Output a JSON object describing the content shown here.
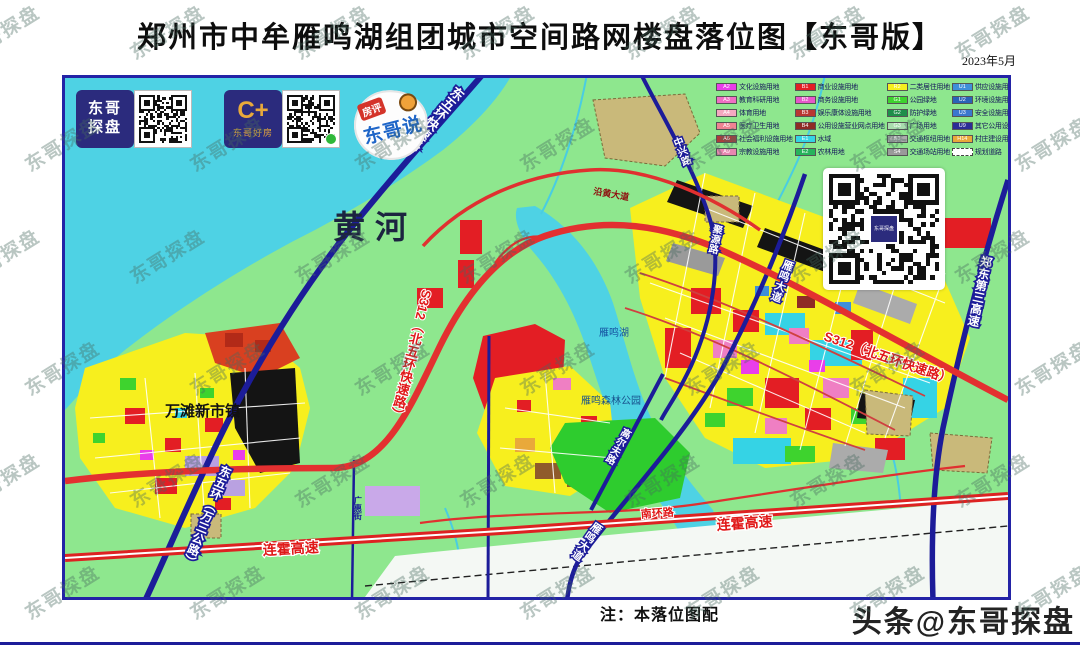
{
  "title": "郑州市中牟雁鸣湖组团城市空间路网楼盘落位图【东哥版】",
  "date": "2023年5月",
  "note": "注：本落位图配",
  "watermark": {
    "tile": "东哥探盘",
    "corner": "头条@东哥探盘"
  },
  "logos": {
    "logo1": {
      "name": "东哥探盘",
      "line1": "东哥",
      "line2": "探盘"
    },
    "logo2": {
      "mark": "C+",
      "name": "东哥好房"
    },
    "logo3": {
      "tag": "房评",
      "name": "东哥说"
    }
  },
  "legend": {
    "columns": [
      {
        "items": [
          {
            "code": "A2",
            "color": "#e93ee9",
            "label": "文化设施用地"
          },
          {
            "code": "A3",
            "color": "#ef6fc3",
            "label": "教育科研用地"
          },
          {
            "code": "A4",
            "color": "#f4a8c0",
            "label": "体育用地"
          },
          {
            "code": "A5",
            "color": "#ef8292",
            "label": "医疗卫生用地"
          },
          {
            "code": "A6",
            "color": "#ae3b3b",
            "label": "社会福利设施用地"
          },
          {
            "code": "A9",
            "color": "#e887b0",
            "label": "宗教设施用地"
          }
        ]
      },
      {
        "items": [
          {
            "code": "B1",
            "color": "#e31e24",
            "label": "商业设施用地"
          },
          {
            "code": "B2",
            "color": "#e557c9",
            "label": "商务设施用地"
          },
          {
            "code": "B3",
            "color": "#b93632",
            "label": "娱乐康体设施用地"
          },
          {
            "code": "B4",
            "color": "#8f2b25",
            "label": "公用设施营业网点用地"
          },
          {
            "code": "E1",
            "color": "#35d3e5",
            "label": "水域"
          },
          {
            "code": "E2",
            "color": "#27b35c",
            "label": "农林用地"
          }
        ]
      },
      {
        "items": [
          {
            "code": "R2",
            "color": "#f7ef1e",
            "label": "二类居住用地"
          },
          {
            "code": "G1",
            "color": "#3ed32e",
            "label": "公园绿地"
          },
          {
            "code": "G2",
            "color": "#1e8f4a",
            "label": "防护绿地"
          },
          {
            "code": "G3",
            "color": "#a9dcae",
            "label": "广场用地"
          },
          {
            "code": "S3",
            "color": "#ababab",
            "label": "交通枢纽用地"
          },
          {
            "code": "S4",
            "color": "#9a9a9a",
            "label": "交通场站用地"
          }
        ]
      },
      {
        "items": [
          {
            "code": "U1",
            "color": "#3f8fd9",
            "label": "供应设施用地"
          },
          {
            "code": "U2",
            "color": "#2b63b8",
            "label": "环境设施用地"
          },
          {
            "code": "U3",
            "color": "#3a78cf",
            "label": "安全设施用地"
          },
          {
            "code": "U9",
            "color": "#2c2c96",
            "label": "其它公用设施用地"
          },
          {
            "code": "H14",
            "color": "#e9a93a",
            "label": "村庄建设用地"
          },
          {
            "code": "",
            "color": "#ffffff",
            "label": "规划道路",
            "dashed": true
          }
        ]
      }
    ]
  },
  "map": {
    "area_labels": {
      "yellow_river": "黄河",
      "wantan": "万滩新市镇",
      "yanming_lake": "雁鸣湖",
      "forest_park": "雁鸣森林公园"
    },
    "road_labels": {
      "dongwuhuan_express": "东五环快速路",
      "s312": "S312（北五环快速路）",
      "dongwuhuan_wansan": "东五环（万三公路）",
      "lianhuo": "连霍高速",
      "nanhuan": "南环路",
      "yanming_avenue": "雁鸣大道",
      "zhongxing": "中兴路",
      "juyuan": "聚源路",
      "golf": "高尔夫路",
      "guanghui": "广惠街",
      "zhengdong_third": "郑东第三高速",
      "yanhuang": "沿黄大道"
    }
  }
}
